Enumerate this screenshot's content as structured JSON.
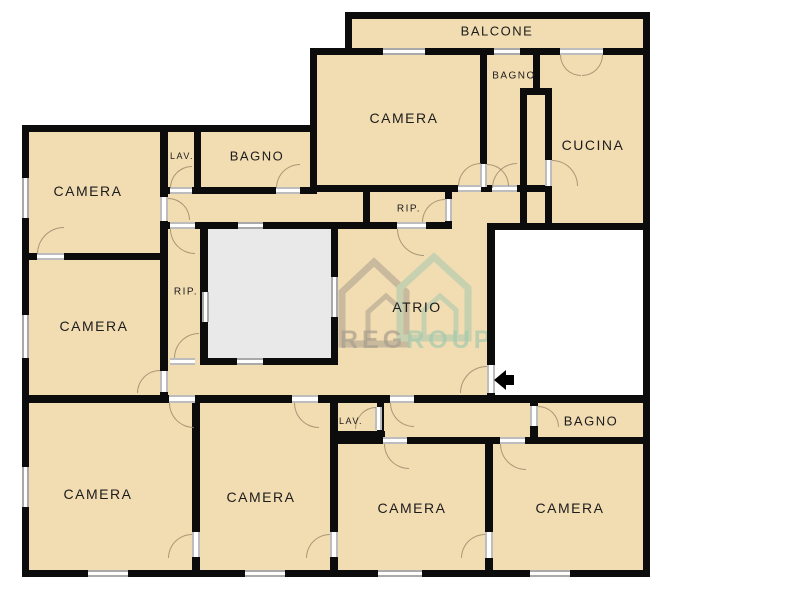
{
  "page": {
    "type": "apartment-floor-plan"
  },
  "rooms": [
    {
      "id": "balcone",
      "label": "BALCONE"
    },
    {
      "id": "camera_tm",
      "label": "CAMERA"
    },
    {
      "id": "bagno_top",
      "label": "BAGNO"
    },
    {
      "id": "cucina",
      "label": "CUCINA"
    },
    {
      "id": "camera_tl",
      "label": "CAMERA"
    },
    {
      "id": "lav_top",
      "label": "LAV."
    },
    {
      "id": "bagno_tl",
      "label": "BAGNO"
    },
    {
      "id": "rip_top",
      "label": "RIP."
    },
    {
      "id": "rip_left",
      "label": "RIP."
    },
    {
      "id": "atrio",
      "label": "ATRIO"
    },
    {
      "id": "camera_ml",
      "label": "CAMERA"
    },
    {
      "id": "camera_b1",
      "label": "CAMERA"
    },
    {
      "id": "camera_b2",
      "label": "CAMERA"
    },
    {
      "id": "lav_b",
      "label": "LAV."
    },
    {
      "id": "bagno_br",
      "label": "BAGNO"
    },
    {
      "id": "camera_b3",
      "label": "CAMERA"
    },
    {
      "id": "camera_b4",
      "label": "CAMERA"
    }
  ],
  "watermark": {
    "gray_text": "REG",
    "green_text": "ROUP"
  },
  "entrance_arrow": {
    "direction": "left"
  },
  "colors": {
    "wall": "#0c0c0c",
    "room_fill": "#f2dcb2",
    "shaft_fill": "#e9e9e9",
    "window_frame": "#a9a9a9",
    "door_frame": "#bdbdbd",
    "door_arc": "#96866a",
    "watermark_gray": "#a89e8d",
    "watermark_green": "#a5c9ad",
    "arrow": "#000000"
  }
}
